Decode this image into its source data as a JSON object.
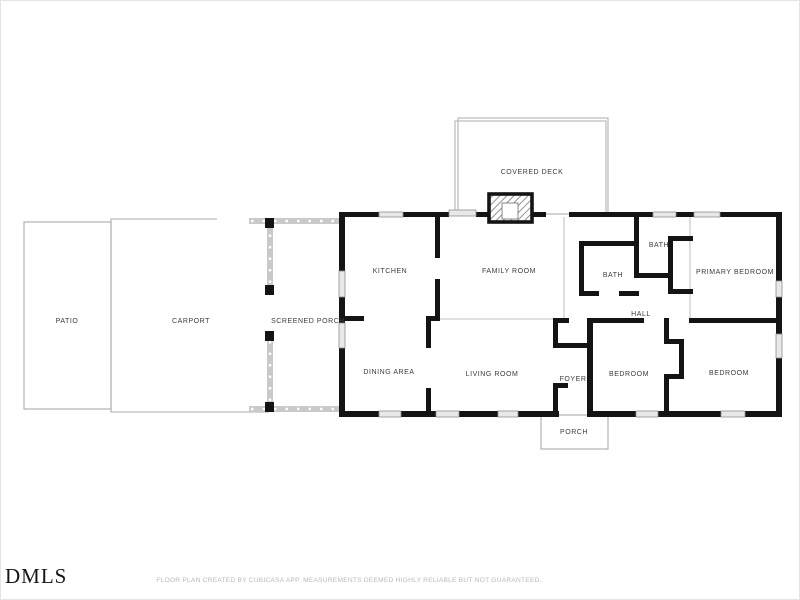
{
  "floor_plan": {
    "rooms": {
      "patio": "PATIO",
      "carport": "CARPORT",
      "screened_porch": "SCREENED PORCH",
      "covered_deck": "COVERED DECK",
      "kitchen": "KITCHEN",
      "family_room": "FAMILY ROOM",
      "dining_area": "DINING AREA",
      "living_room": "LIVING ROOM",
      "foyer": "FOYER",
      "porch": "PORCH",
      "bath_upper": "BATH",
      "bath_lower": "BATH",
      "hall": "HALL",
      "primary_bedroom": "PRIMARY BEDROOM",
      "bedroom_middle": "BEDROOM",
      "bedroom_right": "BEDROOM"
    },
    "colors": {
      "wall": "#141414",
      "label": "#3b3b3b",
      "outdoor_outline": "#ababab",
      "screen_wall": "#c9c9c9",
      "window_fill": "#e8e8e8",
      "disclaimer_text": "#b9b9b9"
    }
  },
  "footer": {
    "logo": "DMLS",
    "disclaimer": "FLOOR PLAN CREATED BY CUBICASA APP. MEASUREMENTS DEEMED HIGHLY RELIABLE BUT NOT GUARANTEED."
  }
}
